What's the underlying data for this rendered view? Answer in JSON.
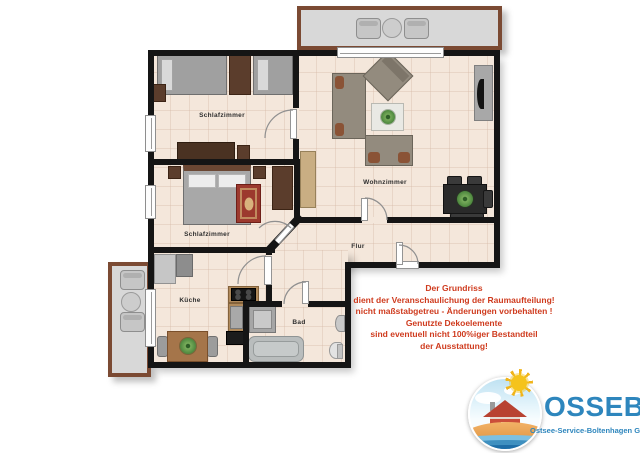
{
  "floor_plan": {
    "rooms": [
      {
        "id": "bedroom-1",
        "label": "Schlafzimmer",
        "furniture": [
          "single-bed",
          "single-bed",
          "dresser",
          "nightstand",
          "desk",
          "chair",
          "window"
        ]
      },
      {
        "id": "bedroom-2",
        "label": "Schlafzimmer",
        "furniture": [
          "double-bed",
          "nightstand",
          "nightstand",
          "rug",
          "wardrobe",
          "window"
        ]
      },
      {
        "id": "living-room",
        "label": "Wohnzimmer",
        "furniture": [
          "sofa",
          "armchair",
          "coffee-table",
          "loveseat",
          "tv",
          "dining-table",
          "cabinet",
          "balcony-door"
        ]
      },
      {
        "id": "hallway",
        "label": "Flur",
        "furniture": [
          "entrance-door"
        ]
      },
      {
        "id": "kitchen",
        "label": "Küche",
        "furniture": [
          "fridge",
          "counter",
          "stove",
          "sink",
          "dining-table",
          "chairs",
          "balcony-door"
        ]
      },
      {
        "id": "bathroom",
        "label": "Bad",
        "furniture": [
          "shower",
          "bathtub",
          "sink",
          "toilet"
        ]
      }
    ],
    "balconies": [
      {
        "id": "balcony-top",
        "furniture": [
          "chair",
          "round-table",
          "chair"
        ]
      },
      {
        "id": "balcony-left",
        "furniture": [
          "chair",
          "round-table",
          "chair"
        ]
      }
    ],
    "disclaimer": {
      "color": "#cf3b1e",
      "lines": [
        "Der Grundriss",
        "dient der Veranschaulichung der Raumaufteilung!",
        "nicht maßstabgetreu - Änderungen vorbehalten !",
        "Genutzte Dekoelemente",
        "sind eventuell nicht 100%iger Bestandteil",
        "der Ausstattung!"
      ]
    }
  },
  "logo": {
    "brand": "OSSEBO",
    "subtitle": "Ostsee-Service-Boltenhagen GmbH",
    "brand_color": "#2e86bd",
    "emblem_icons": [
      "sun-icon",
      "cloud-icon",
      "house-icon",
      "beach-icon",
      "waves-icon"
    ]
  },
  "colors": {
    "wall": "#151515",
    "floor": "#f4e7db",
    "balcony_floor": "#d8d8d8",
    "balcony_border": "#7b4a33",
    "disclaimer_red": "#cf3b1e",
    "logo_blue": "#2e86bd"
  }
}
